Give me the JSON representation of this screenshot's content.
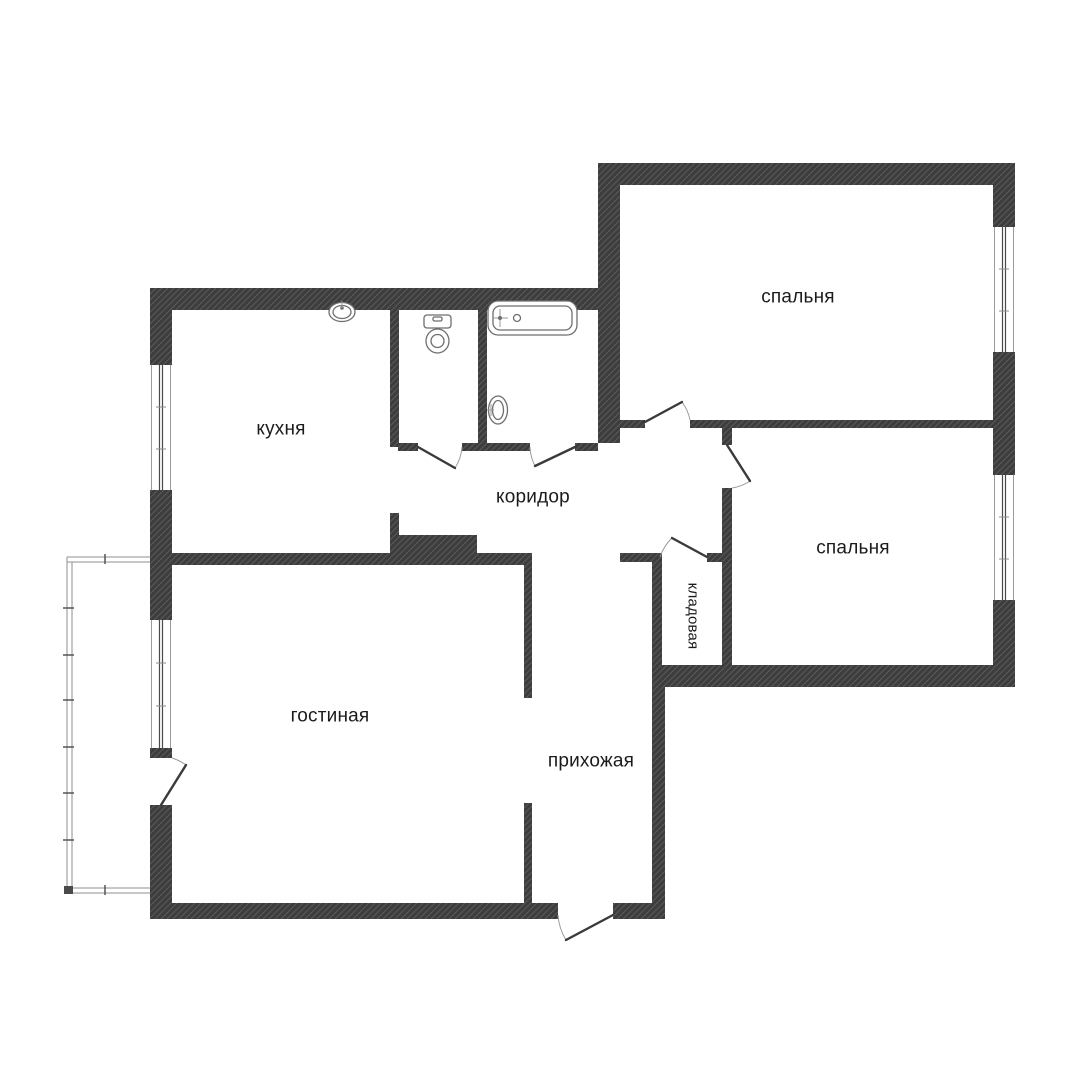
{
  "floorplan": {
    "background_color": "#ffffff",
    "wall_color": "#3d3d3d",
    "wall_hatch_color": "#5a5a5a",
    "label_color": "#1b1b1b",
    "door_leaf_color": "#3a3a3a",
    "door_arc_color": "#9a9a9a",
    "window_line_color": "#8c8c8c",
    "balcony_line_color": "#8f8f8f",
    "rooms": {
      "bedroom_top": {
        "label": "спальня"
      },
      "bedroom_right": {
        "label": "спальня"
      },
      "kitchen": {
        "label": "кухня"
      },
      "corridor": {
        "label": "коридор"
      },
      "pantry": {
        "label": "кладовая"
      },
      "living_room": {
        "label": "гостиная"
      },
      "hallway": {
        "label": "прихожая"
      }
    },
    "fixtures": {
      "bathtub": "bathtub-icon",
      "toilet": "toilet-icon",
      "wash_basin": "wash-basin-icon",
      "kitchen_sink": "kitchen-sink-icon"
    },
    "features": {
      "balcony": "balcony",
      "window_count": 4,
      "door_count": 7
    }
  }
}
